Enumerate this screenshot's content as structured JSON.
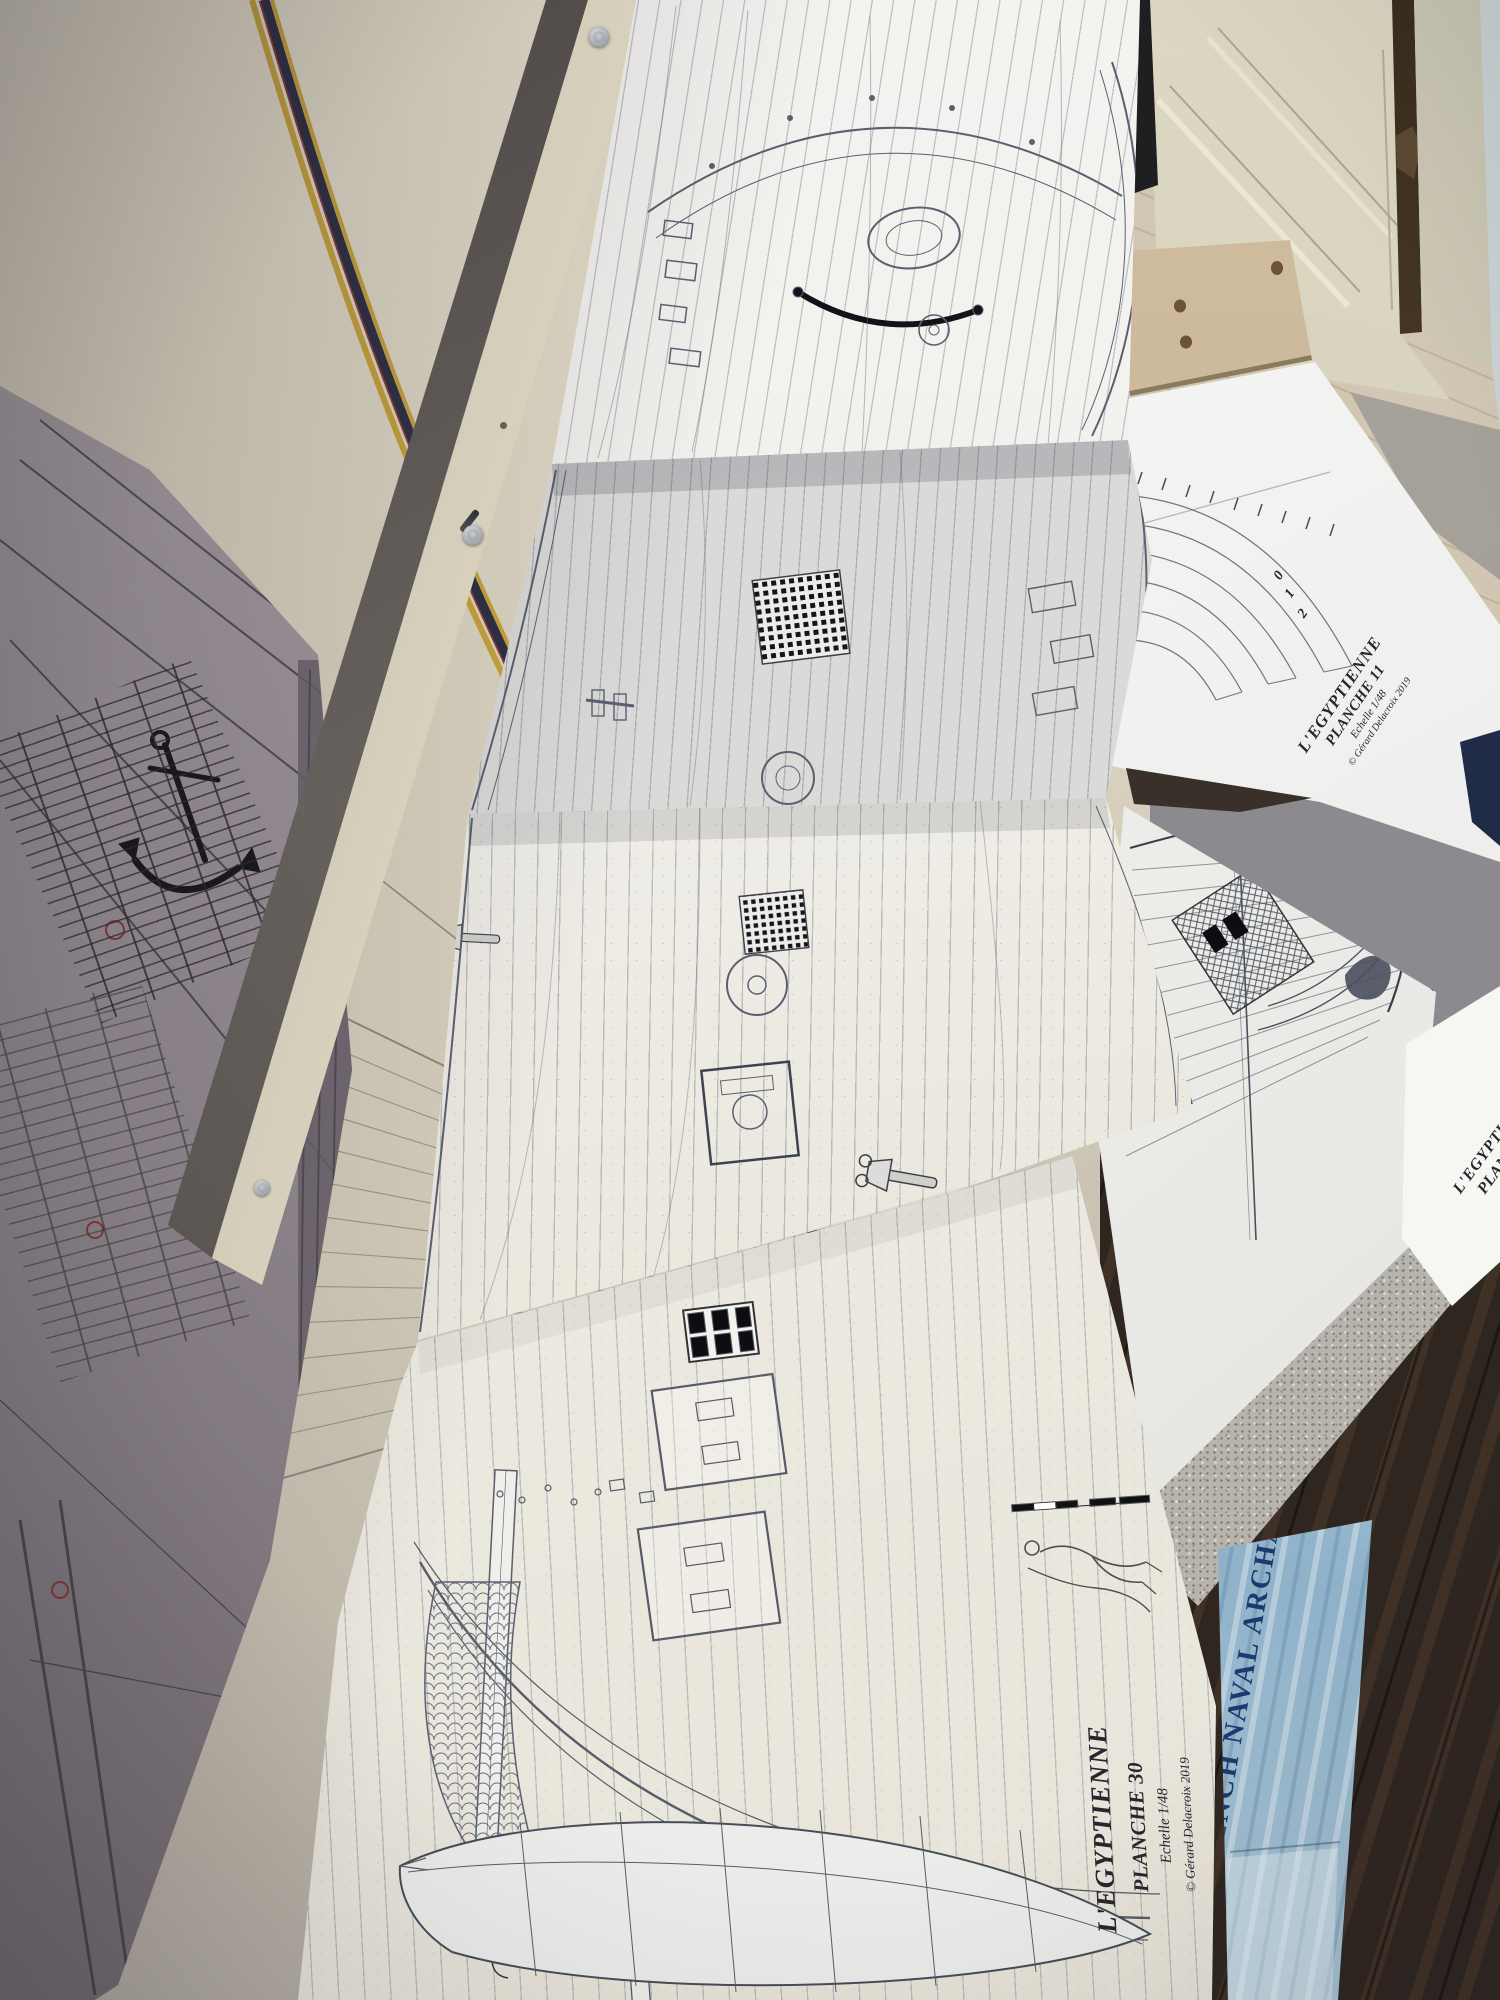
{
  "plans": {
    "planche30": {
      "series": "L'EGYPTIENNE",
      "sheet": "PLANCHE 30",
      "scale": "Echelle 1/48",
      "credit": "© Gérard Delacroix 2019"
    },
    "planche11": {
      "series": "L'EGYPTIENNE",
      "sheet": "PLANCHE 11",
      "scale": "Echelle 1/48",
      "credit": "© Gérard Delacroix 2019",
      "frame_numbers": [
        "2",
        "1",
        "0"
      ]
    },
    "planche39": {
      "series": "L'EGYPTIENNE",
      "sheet": "PLANCHE 39"
    },
    "book": {
      "title_visible": "FRENCH NAVAL ARCHA"
    },
    "colors": {
      "stripe_yellow": "#c9a43a",
      "stripe_red": "#8e3a30",
      "stripe_navy": "#2c2f45",
      "book_blue": "#8fb4cc",
      "book_text_blue": "#1c3a6e"
    }
  }
}
